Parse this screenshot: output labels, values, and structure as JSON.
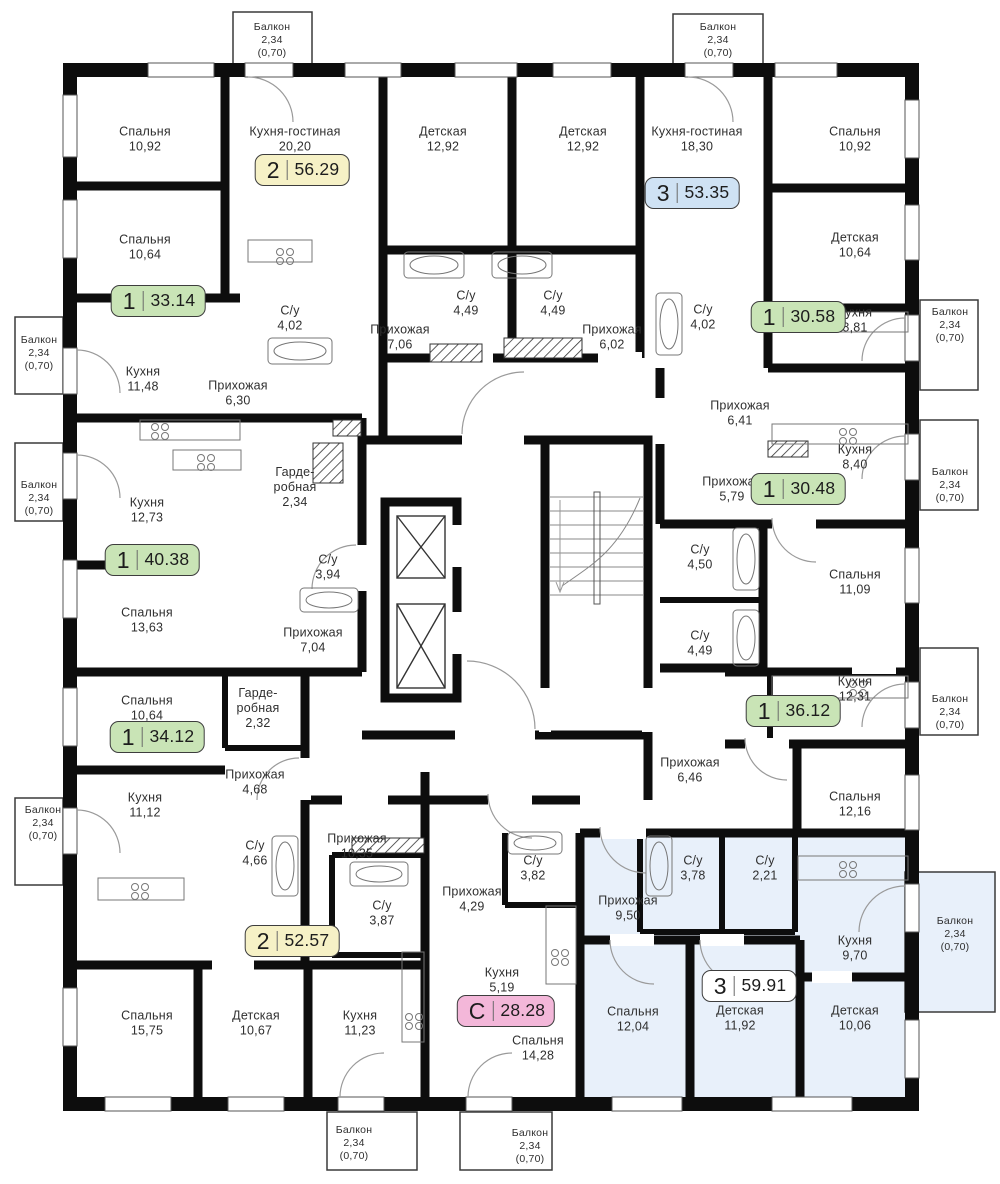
{
  "plan_title": "Floor plan",
  "colors": {
    "wall": "#0d0d0d",
    "selected_apartment_fill": "#e8f0fa",
    "badge_yellow": "#f6f1c6",
    "badge_green": "#c9e4b6",
    "badge_blue": "#cfe2f4",
    "badge_pink": "#f3b7d9",
    "badge_white": "#ffffff",
    "label_text": "#2f2f2f"
  },
  "rooms": [
    {
      "name": "Спальня",
      "area": "10,92",
      "x": 145,
      "y": 139
    },
    {
      "name": "Кухня-гостиная",
      "area": "20,20",
      "x": 295,
      "y": 139
    },
    {
      "name": "Детская",
      "area": "12,92",
      "x": 443,
      "y": 139
    },
    {
      "name": "Детская",
      "area": "12,92",
      "x": 583,
      "y": 139
    },
    {
      "name": "Кухня-гостиная",
      "area": "18,30",
      "x": 697,
      "y": 139
    },
    {
      "name": "Спальня",
      "area": "10,92",
      "x": 855,
      "y": 139
    },
    {
      "name": "Спальня",
      "area": "10,64",
      "x": 145,
      "y": 247
    },
    {
      "name": "Детская",
      "area": "10,64",
      "x": 855,
      "y": 245
    },
    {
      "name": "С/у",
      "area": "4,02",
      "x": 290,
      "y": 318
    },
    {
      "name": "С/у",
      "area": "4,49",
      "x": 466,
      "y": 303
    },
    {
      "name": "С/у",
      "area": "4,49",
      "x": 553,
      "y": 303
    },
    {
      "name": "Прихожая",
      "area": "7,06",
      "x": 400,
      "y": 337
    },
    {
      "name": "Прихожая",
      "area": "6,02",
      "x": 612,
      "y": 337
    },
    {
      "name": "С/у",
      "area": "4,02",
      "x": 703,
      "y": 317
    },
    {
      "name": "Кухня",
      "area": "8,81",
      "x": 855,
      "y": 320
    },
    {
      "name": "Кухня",
      "area": "11,48",
      "x": 143,
      "y": 379
    },
    {
      "name": "Прихожая",
      "area": "6,30",
      "x": 238,
      "y": 393
    },
    {
      "name": "Прихожая",
      "area": "6,41",
      "x": 740,
      "y": 413
    },
    {
      "name": "Кухня",
      "area": "8,40",
      "x": 855,
      "y": 457
    },
    {
      "name": "Гарде-\nробная",
      "area": "2,34",
      "x": 295,
      "y": 487
    },
    {
      "name": "Кухня",
      "area": "12,73",
      "x": 147,
      "y": 510
    },
    {
      "name": "Прихожая",
      "area": "5,79",
      "x": 732,
      "y": 489
    },
    {
      "name": "С/у",
      "area": "3,94",
      "x": 328,
      "y": 567
    },
    {
      "name": "С/у",
      "area": "4,50",
      "x": 700,
      "y": 557
    },
    {
      "name": "Спальня",
      "area": "11,09",
      "x": 855,
      "y": 582
    },
    {
      "name": "Спальня",
      "area": "13,63",
      "x": 147,
      "y": 620
    },
    {
      "name": "Прихожая",
      "area": "7,04",
      "x": 313,
      "y": 640
    },
    {
      "name": "С/у",
      "area": "4,49",
      "x": 700,
      "y": 643
    },
    {
      "name": "Кухня",
      "area": "12,31",
      "x": 855,
      "y": 689
    },
    {
      "name": "Спальня",
      "area": "10,64",
      "x": 147,
      "y": 708
    },
    {
      "name": "Гарде-\nробная",
      "area": "2,32",
      "x": 258,
      "y": 708
    },
    {
      "name": "Прихожая",
      "area": "6,46",
      "x": 690,
      "y": 770
    },
    {
      "name": "Прихожая",
      "area": "4,68",
      "x": 255,
      "y": 782
    },
    {
      "name": "Спальня",
      "area": "12,16",
      "x": 855,
      "y": 804
    },
    {
      "name": "Кухня",
      "area": "11,12",
      "x": 145,
      "y": 805
    },
    {
      "name": "Прихожая",
      "area": "10,35",
      "x": 357,
      "y": 846
    },
    {
      "name": "С/у",
      "area": "4,66",
      "x": 255,
      "y": 853
    },
    {
      "name": "С/у",
      "area": "3,82",
      "x": 533,
      "y": 868
    },
    {
      "name": "С/у",
      "area": "3,78",
      "x": 693,
      "y": 868
    },
    {
      "name": "С/у",
      "area": "2,21",
      "x": 765,
      "y": 868
    },
    {
      "name": "Прихожая",
      "area": "4,29",
      "x": 472,
      "y": 899
    },
    {
      "name": "Прихожая",
      "area": "9,50",
      "x": 628,
      "y": 908
    },
    {
      "name": "С/у",
      "area": "3,87",
      "x": 382,
      "y": 913
    },
    {
      "name": "Кухня",
      "area": "9,70",
      "x": 855,
      "y": 948
    },
    {
      "name": "Кухня",
      "area": "5,19",
      "x": 502,
      "y": 980
    },
    {
      "name": "Спальня",
      "area": "15,75",
      "x": 147,
      "y": 1023
    },
    {
      "name": "Детская",
      "area": "10,67",
      "x": 256,
      "y": 1023
    },
    {
      "name": "Кухня",
      "area": "11,23",
      "x": 360,
      "y": 1023
    },
    {
      "name": "Спальня",
      "area": "12,04",
      "x": 633,
      "y": 1019
    },
    {
      "name": "Детская",
      "area": "11,92",
      "x": 740,
      "y": 1018
    },
    {
      "name": "Детская",
      "area": "10,06",
      "x": 855,
      "y": 1018
    },
    {
      "name": "Спальня",
      "area": "14,28",
      "x": 538,
      "y": 1048
    }
  ],
  "badges": [
    {
      "rooms": "2",
      "area": "56.29",
      "style": "yellow",
      "x": 302,
      "y": 170
    },
    {
      "rooms": "3",
      "area": "53.35",
      "style": "blue",
      "x": 692,
      "y": 193
    },
    {
      "rooms": "1",
      "area": "33.14",
      "style": "green",
      "x": 158,
      "y": 301
    },
    {
      "rooms": "1",
      "area": "30.58",
      "style": "green",
      "x": 798,
      "y": 317
    },
    {
      "rooms": "1",
      "area": "30.48",
      "style": "green",
      "x": 798,
      "y": 489
    },
    {
      "rooms": "1",
      "area": "40.38",
      "style": "green",
      "x": 152,
      "y": 560
    },
    {
      "rooms": "1",
      "area": "36.12",
      "style": "green",
      "x": 793,
      "y": 711
    },
    {
      "rooms": "1",
      "area": "34.12",
      "style": "green",
      "x": 157,
      "y": 737
    },
    {
      "rooms": "2",
      "area": "52.57",
      "style": "yellow",
      "x": 292,
      "y": 941
    },
    {
      "rooms": "3",
      "area": "59.91",
      "style": "white",
      "x": 749,
      "y": 986
    },
    {
      "rooms": "С",
      "area": "28.28",
      "style": "pink",
      "x": 506,
      "y": 1011
    }
  ],
  "balconies": [
    {
      "name": "Балкон",
      "area": "2,34",
      "coef": "(0,70)",
      "x": 272,
      "y": 40
    },
    {
      "name": "Балкон",
      "area": "2,34",
      "coef": "(0,70)",
      "x": 718,
      "y": 40
    },
    {
      "name": "Балкон",
      "area": "2,34",
      "coef": "(0,70)",
      "x": 39,
      "y": 353
    },
    {
      "name": "Балкон",
      "area": "2,34",
      "coef": "(0,70)",
      "x": 39,
      "y": 498
    },
    {
      "name": "Балкон",
      "area": "2,34",
      "coef": "(0,70)",
      "x": 43,
      "y": 823
    },
    {
      "name": "Балкон",
      "area": "2,34",
      "coef": "(0,70)",
      "x": 950,
      "y": 325
    },
    {
      "name": "Балкон",
      "area": "2,34",
      "coef": "(0,70)",
      "x": 950,
      "y": 485
    },
    {
      "name": "Балкон",
      "area": "2,34",
      "coef": "(0,70)",
      "x": 950,
      "y": 712
    },
    {
      "name": "Балкон",
      "area": "2,34",
      "coef": "(0,70)",
      "x": 955,
      "y": 934
    },
    {
      "name": "Балкон",
      "area": "2,34",
      "coef": "(0,70)",
      "x": 354,
      "y": 1143
    },
    {
      "name": "Балкон",
      "area": "2,34",
      "coef": "(0,70)",
      "x": 530,
      "y": 1146
    }
  ]
}
